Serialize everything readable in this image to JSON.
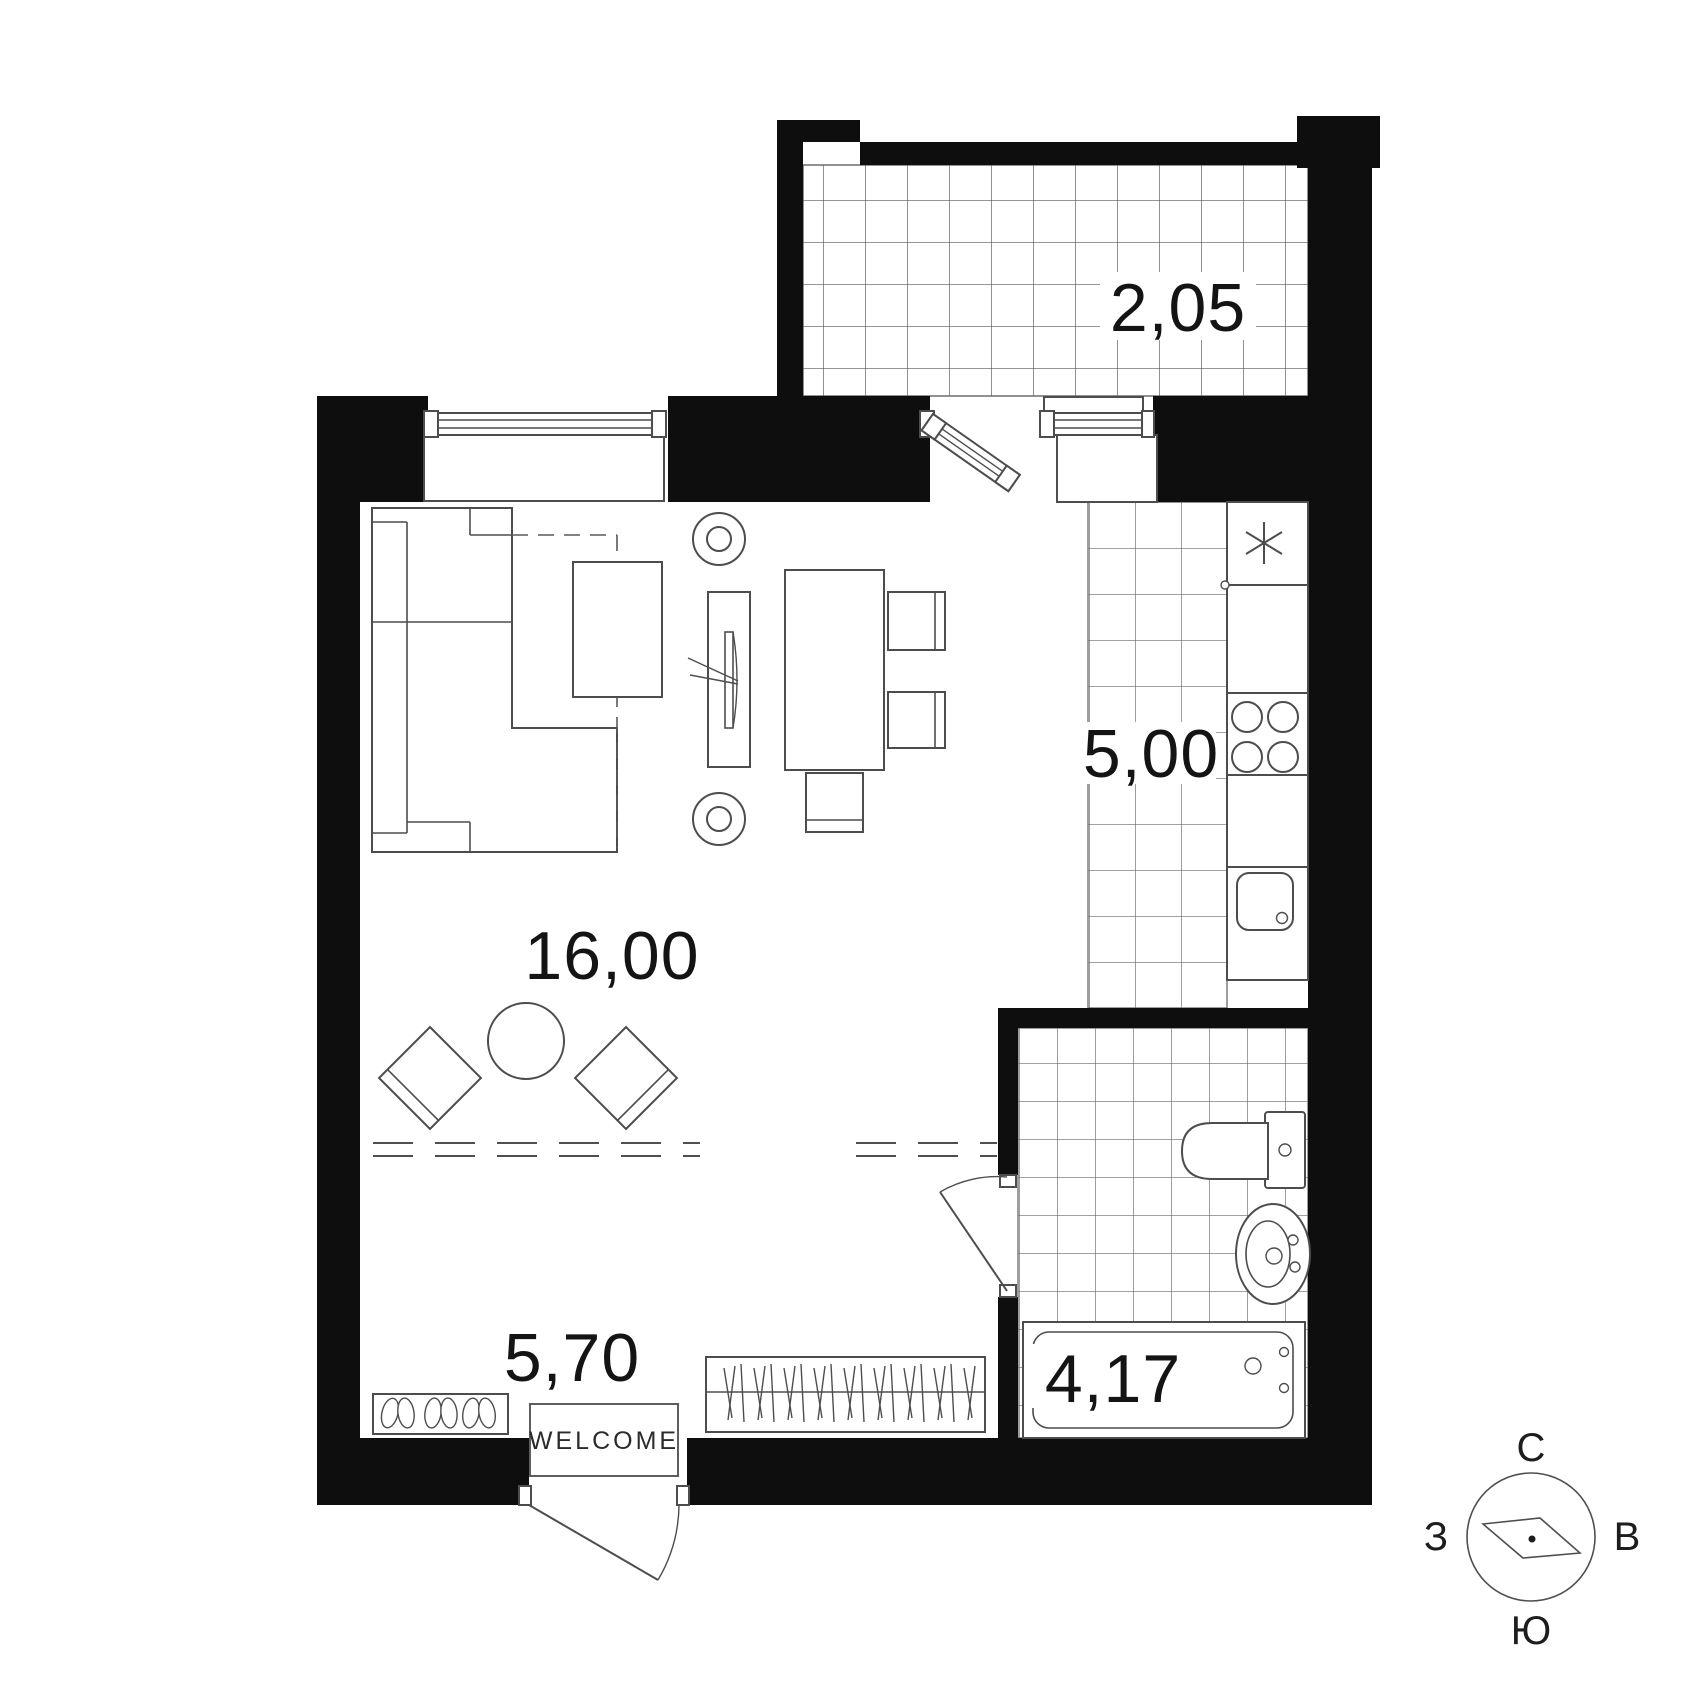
{
  "plan_title": "apartment floor plan",
  "rooms": {
    "living": {
      "area": "16,00"
    },
    "kitchen": {
      "area": "5,00"
    },
    "hallway": {
      "area": "5,70"
    },
    "bathroom": {
      "area": "4,17"
    },
    "balcony": {
      "area": "2,05"
    }
  },
  "labels": {
    "door_mat": "WELCOME"
  },
  "compass": {
    "north": "С",
    "east": "В",
    "south": "Ю",
    "west": "З"
  },
  "colors": {
    "wall": "#0e0e0e",
    "furniture_line": "#4d4d4d",
    "tile_line": "#6a6a6a",
    "background": "#ffffff",
    "text": "#141414"
  }
}
